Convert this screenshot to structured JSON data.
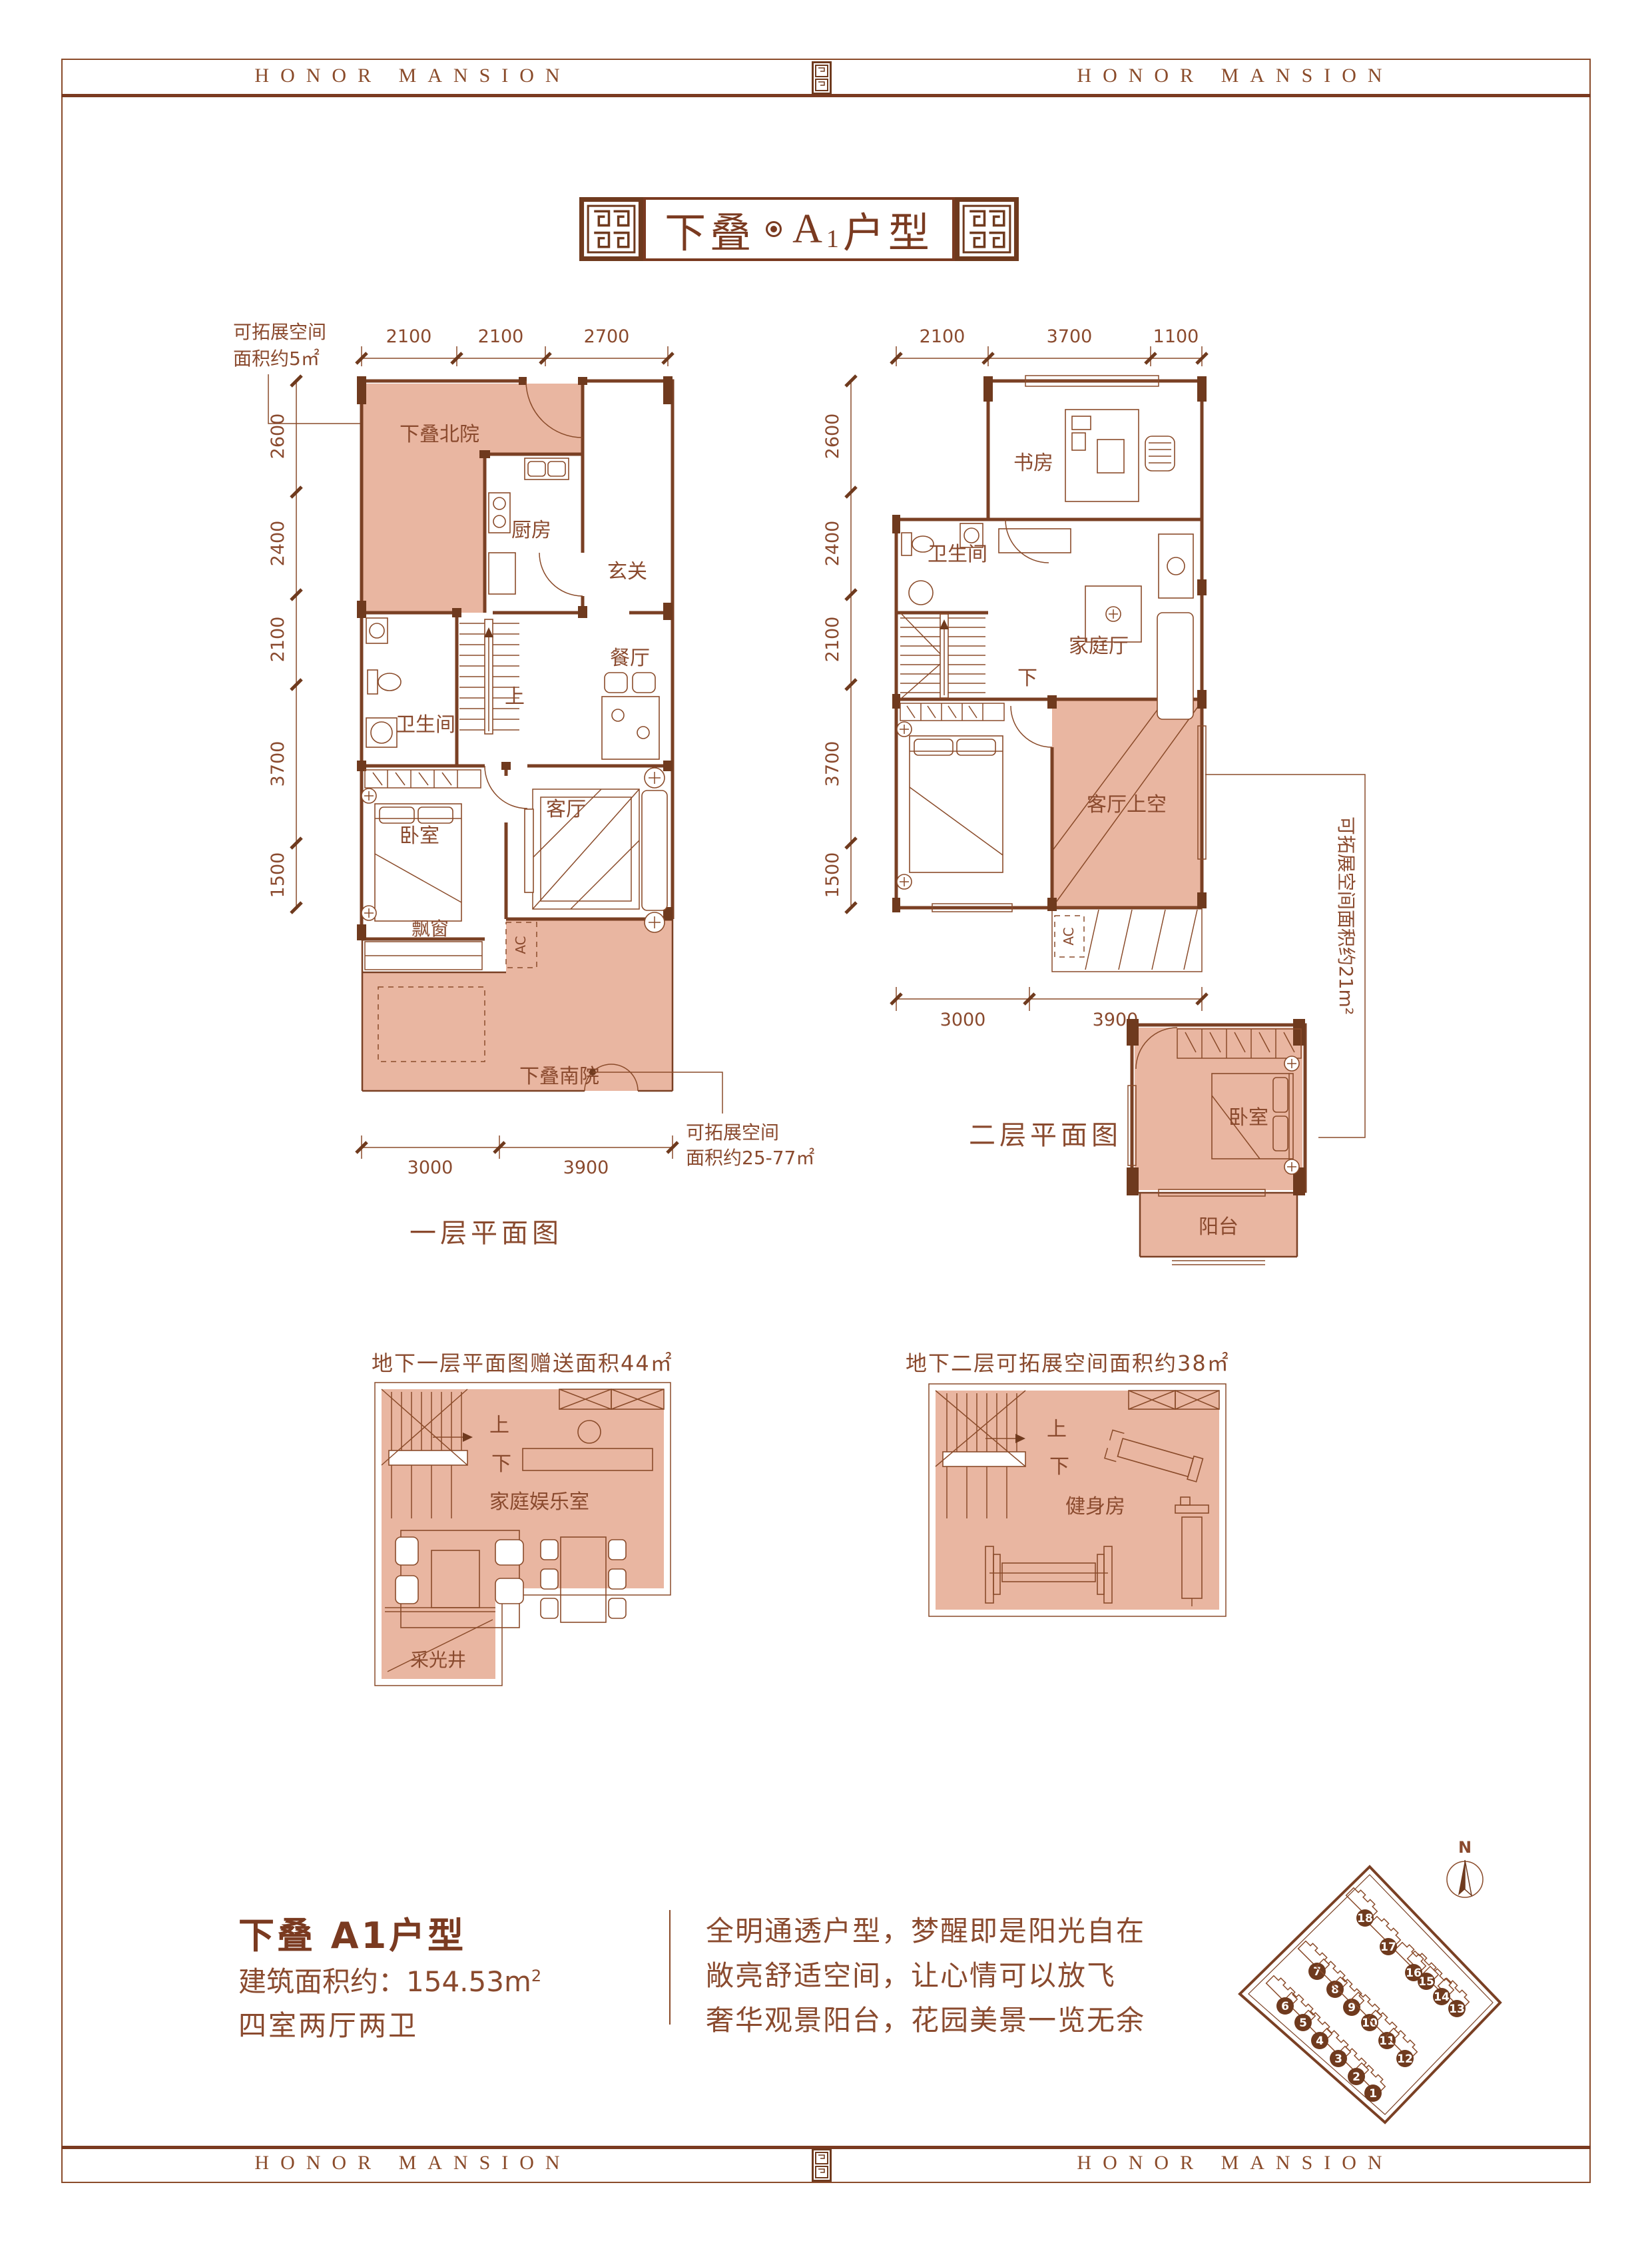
{
  "header": {
    "brand": "HONOR MANSION"
  },
  "footer": {
    "brand": "HONOR MANSION"
  },
  "title": {
    "part1": "下叠",
    "unit": "A",
    "unit_sub": "1",
    "part2": "户型"
  },
  "floor1": {
    "caption": "一层平面图",
    "dims_top": [
      "2100",
      "2100",
      "2700"
    ],
    "dims_left": [
      "2600",
      "2400",
      "2100",
      "3700",
      "1500"
    ],
    "dims_bottom": [
      "3000",
      "3900"
    ],
    "annotation_nw": [
      "可拓展空间",
      "面积约5㎡"
    ],
    "annotation_se": [
      "可拓展空间",
      "面积约25-77㎡"
    ],
    "rooms": {
      "north_yard": "下叠北院",
      "kitchen": "厨房",
      "foyer": "玄关",
      "bathroom": "卫生间",
      "dining": "餐厅",
      "stairs_up": "上",
      "bedroom": "卧室",
      "living": "客厅",
      "bay_window": "飘窗",
      "ac": "AC",
      "south_yard": "下叠南院"
    }
  },
  "floor2": {
    "caption": "二层平面图",
    "dims_top": [
      "2100",
      "3700",
      "1100"
    ],
    "dims_left": [
      "2600",
      "2400",
      "2100",
      "3700",
      "1500"
    ],
    "dims_bottom": [
      "3000",
      "3900"
    ],
    "annotation_right": "可拓展空间面积约21m²",
    "rooms": {
      "study": "书房",
      "bathroom": "卫生间",
      "stairs_down": "下",
      "family_hall": "家庭厅",
      "living_void": "客厅上空",
      "ac": "AC"
    }
  },
  "annex": {
    "rooms": {
      "bedroom": "卧室",
      "balcony": "阳台"
    }
  },
  "basement1": {
    "title": "地下一层平面图赠送面积44㎡",
    "rooms": {
      "up": "上",
      "down": "下",
      "entertainment": "家庭娱乐室",
      "light_well": "采光井"
    }
  },
  "basement2": {
    "title": "地下二层可拓展空间面积约38㎡",
    "rooms": {
      "up": "上",
      "down": "下",
      "gym": "健身房"
    }
  },
  "info": {
    "unit_title": "下叠 A1户型",
    "area_label": "建筑面积约：",
    "area_value": "154.53m",
    "area_sup": "2",
    "layout": "四室两厅两卫",
    "slogans": [
      "全明通透户型，梦醒即是阳光自在",
      "敞亮舒适空间，让心情可以放飞",
      "奢华观景阳台，花园美景一览无余"
    ]
  },
  "siteplan": {
    "north": "N",
    "buildings": [
      "1",
      "2",
      "3",
      "4",
      "5",
      "6",
      "7",
      "8",
      "9",
      "10",
      "11",
      "12",
      "13",
      "14",
      "15",
      "16",
      "17",
      "18"
    ]
  },
  "colors": {
    "line": "#8a4b2a",
    "wall": "#6f3a1e",
    "shade": "#e9b6a1",
    "text": "#8a4a2e"
  }
}
